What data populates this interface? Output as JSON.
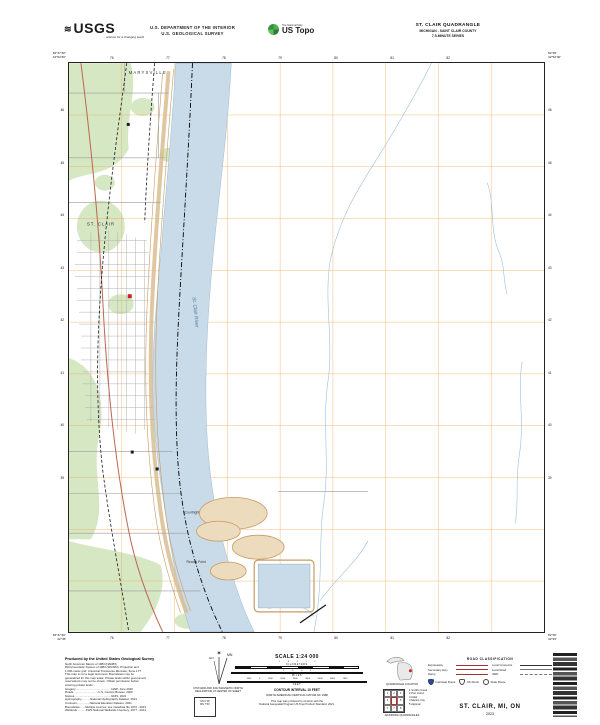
{
  "palette": {
    "river": "#c9dbe9",
    "vegetation": "#d6e7c3",
    "utm_grid": "#f0a44c",
    "contour": "#c79b62",
    "red_feature": "#cc2222",
    "road_red": "#a03333",
    "interstate_blue": "#2b4b9b"
  },
  "header": {
    "usgs_wave": "≋",
    "usgs_brand": "USGS",
    "usgs_tagline": "science for a changing world",
    "dept_line1": "U.S. DEPARTMENT OF THE INTERIOR",
    "dept_line2": "U.S. GEOLOGICAL SURVEY",
    "ustopo_tagline": "The National Map",
    "ustopo_brand": "US Topo",
    "quad_title": "ST. CLAIR QUADRANGLE",
    "quad_subtitle": "MICHIGAN - SAINT CLAIR COUNTY",
    "quad_series": "7.5-MINUTE SERIES"
  },
  "map": {
    "labels": {
      "city_north": "MARYSVILLE",
      "city": "ST. CLAIR",
      "river": "St. Clair River",
      "east_bank_town": "Courtright",
      "point": "Recors Point"
    },
    "corners": {
      "top_left_lon": "82°37'30\"",
      "top_left_lat": "42°52'30\"",
      "top_right_lon": "82°30'",
      "top_right_lat": "42°52'30\"",
      "bottom_left_lon": "82°37'30\"",
      "bottom_left_lat": "42°45'",
      "bottom_right_lon": "82°30'",
      "bottom_right_lat": "42°45'"
    },
    "top_grid_labels": [
      "76",
      "77",
      "78",
      "79",
      "80",
      "81",
      "82"
    ],
    "bottom_grid_labels": [
      "76",
      "77",
      "78",
      "79",
      "80",
      "81",
      "82"
    ],
    "left_grid_labels": [
      "46",
      "45",
      "44",
      "43",
      "42",
      "41",
      "40",
      "39"
    ],
    "right_grid_labels": [
      "46",
      "45",
      "44",
      "43",
      "42",
      "41",
      "40",
      "39"
    ]
  },
  "footer": {
    "produced": {
      "title": "Produced by the United States Geological Survey",
      "lines": [
        "North American Datum of 1983 (NAD83)",
        "World Geodetic System of 1984 (WGS84).  Projection and",
        "1 000-meter grid: Universal Transverse Mercator, Zone 17T",
        "This map is not a legal document. Boundaries may be",
        "generalized for this map scale. Private lands within government",
        "reservations may not be shown. Obtain permission before",
        "entering private lands.",
        "Imagery.............................................NAIP, June 2020",
        "Roads...............................U.S. Census Bureau, 2020",
        "Names..............................................GNIS, 2021",
        "Hydrography...........National Hydrography Dataset, 2021",
        "Contours................National Elevation Dataset, 2021",
        "Boundaries.......Multiple sources; see metadata file 1972 - 2021",
        "Wetlands...........FWS National Wetlands Inventory, 1977 - 2014"
      ]
    },
    "declination": {
      "star": "✶",
      "mn_label": "MN",
      "gn_label": "GN",
      "caption1": "UTM GRID AND 2022 MAGNETIC NORTH",
      "caption2": "DECLINATION AT CENTER OF SHEET",
      "box_line1": "GN 0°19'",
      "box_line2": "MN 7°30'"
    },
    "scale": {
      "title": "SCALE 1:24 000",
      "km_numbers": "1 .5 0 1 2",
      "km_label": "KILOMETERS",
      "mi_numbers": "1 .5 0 1",
      "mi_label": "MILES",
      "ft_numbers": "1000 0 1000 2000 3000 4000 5000 6000 7000",
      "ft_label": "FEET",
      "contour_note": "CONTOUR INTERVAL 10 FEET",
      "datum_note": "NORTH AMERICAN VERTICAL DATUM OF 1988",
      "std_note1": "This map was produced to conform with the",
      "std_note2": "National Geospatial Program US Topo Product Standard, 2021."
    },
    "location": {
      "state_caption": "QUADRANGLE LOCATION",
      "grid_numbers": [
        "1",
        "2",
        "3",
        "4",
        "5",
        "6",
        "7",
        "8"
      ],
      "adjoining": [
        "1 Smiths Creek",
        "2 Port Huron",
        "3 Adair",
        "4 Marine City",
        "5 Algonac"
      ],
      "adjoining_caption": "ADJOINING QUADRANGLES"
    },
    "roads": {
      "title": "ROAD CLASSIFICATION",
      "col1": [
        "Expressway",
        "Secondary Hwy",
        "Ramp"
      ],
      "col2": [
        "Local Connector",
        "Local Road",
        "4WD"
      ],
      "shields": [
        "Interstate Route",
        "US Route",
        "State Route"
      ]
    },
    "title_block": {
      "title": "ST. CLAIR,  MI, ON",
      "year": "2023"
    }
  }
}
